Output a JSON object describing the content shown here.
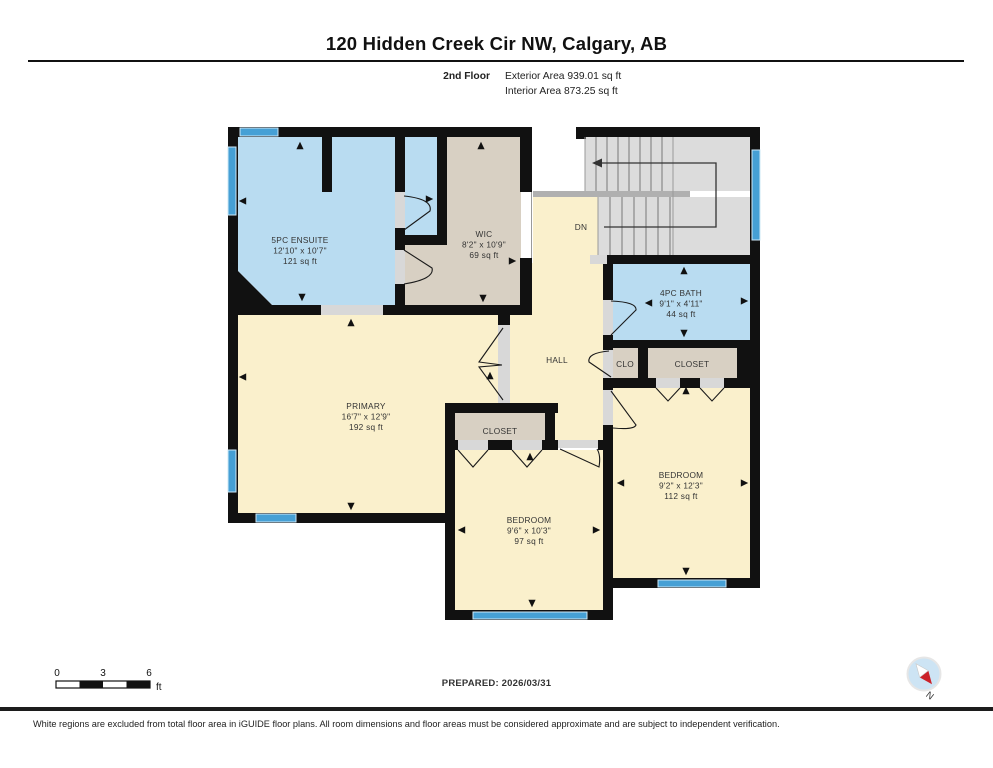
{
  "header": {
    "title": "120 Hidden Creek Cir NW, Calgary, AB",
    "floor_label": "2nd Floor",
    "exterior_area": "Exterior Area 939.01 sq ft",
    "interior_area": "Interior Area 873.25 sq ft"
  },
  "plan": {
    "rooms": [
      {
        "id": "ensuite",
        "name": "5PC ENSUITE",
        "dims": "12'10\" x 10'7\"",
        "area": "121 sq ft"
      },
      {
        "id": "wic",
        "name": "WIC",
        "dims": "8'2\" x 10'9\"",
        "area": "69 sq ft"
      },
      {
        "id": "bath",
        "name": "4PC BATH",
        "dims": "9'1\" x 4'11\"",
        "area": "44 sq ft"
      },
      {
        "id": "primary",
        "name": "PRIMARY",
        "dims": "16'7\" x 12'9\"",
        "area": "192 sq ft"
      },
      {
        "id": "bedroom-bottom",
        "name": "BEDROOM",
        "dims": "9'6\" x 10'3\"",
        "area": "97 sq ft"
      },
      {
        "id": "bedroom-right",
        "name": "BEDROOM",
        "dims": "9'2\" x 12'3\"",
        "area": "112 sq ft"
      }
    ],
    "labels": {
      "hall": "HALL",
      "clo": "CLO",
      "closet_right": "CLOSET",
      "closet_bottom": "CLOSET",
      "stairs_down": "DN"
    },
    "colors": {
      "wall": "#111111",
      "wet_room": "#b9dcf1",
      "dry_room": "#faf0cc",
      "closet_room": "#d8d0c3",
      "stairs": "#dcdcdc",
      "window": "#46a0d5",
      "opening": "#d8d8d8"
    }
  },
  "footer": {
    "scale": {
      "tick0": "0",
      "tick3": "3",
      "tick6": "6",
      "unit": "ft"
    },
    "prepared": "PREPARED: 2026/03/31",
    "compass_label": "N",
    "disclaimer": "White regions are excluded from total floor area in iGUIDE floor plans. All room dimensions and floor areas must be considered approximate and are subject to independent verification."
  }
}
